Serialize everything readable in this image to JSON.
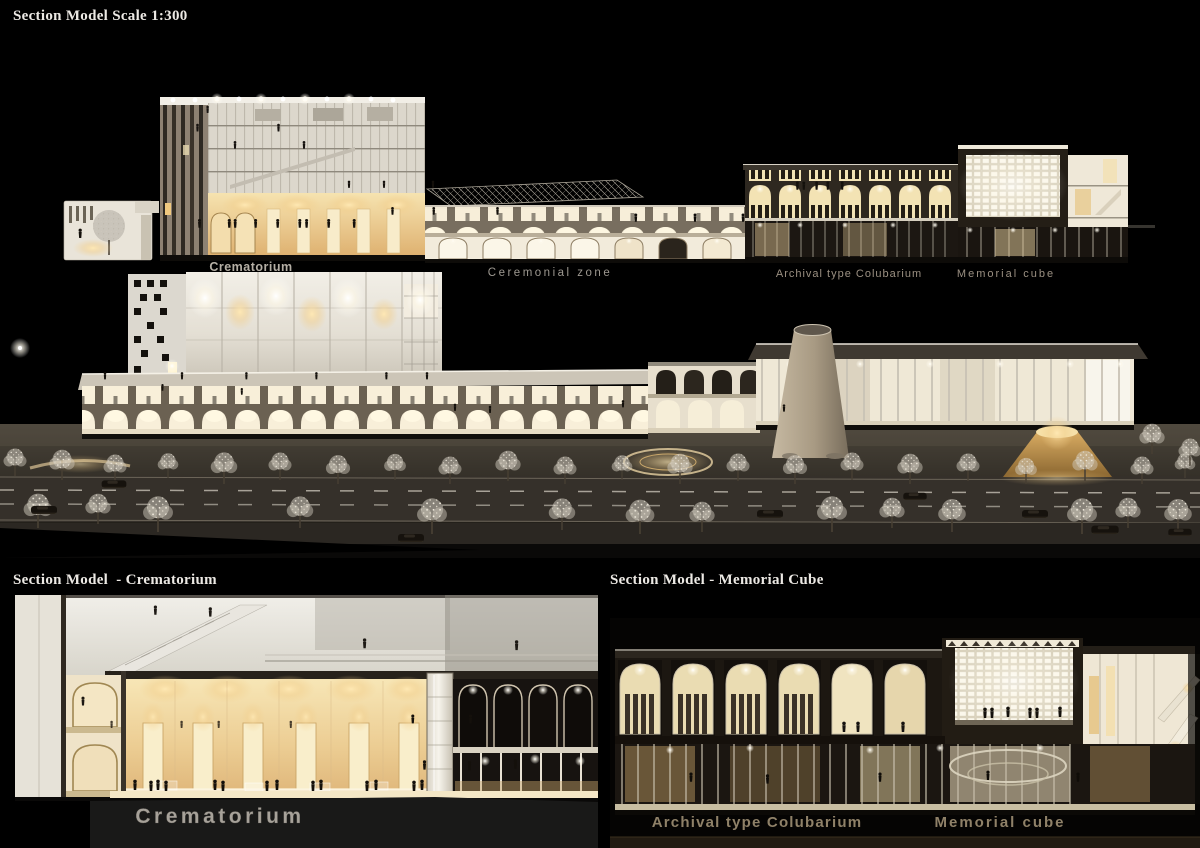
{
  "titles": {
    "scale_model": "Section Model Scale 1:300",
    "crematorium_section": "Section Model  - Crematorium",
    "memorial_section": "Section Model - Memorial Cube"
  },
  "long_section_labels": {
    "crematorium": "Crematorium",
    "ceremonial_zone": "Ceremonial zone",
    "archival_columbarium": "Archival type Colubarium",
    "memorial_cube": "Memorial cube"
  },
  "crematorium_closeup": {
    "label": "Crematorium"
  },
  "memorial_closeup": {
    "archival_label": "Archival type Colubarium",
    "memorial_label": "Memorial cube"
  },
  "colors": {
    "background": "#000000",
    "warm_glow": "#f0d49a",
    "amber_hall": "#e3bc82",
    "model_cream": "#efe8da",
    "structure_tan": "#8a7a5e",
    "label_gray": "#b0aba1",
    "label_tan": "#8f8168",
    "title_white": "#ece9e4"
  }
}
